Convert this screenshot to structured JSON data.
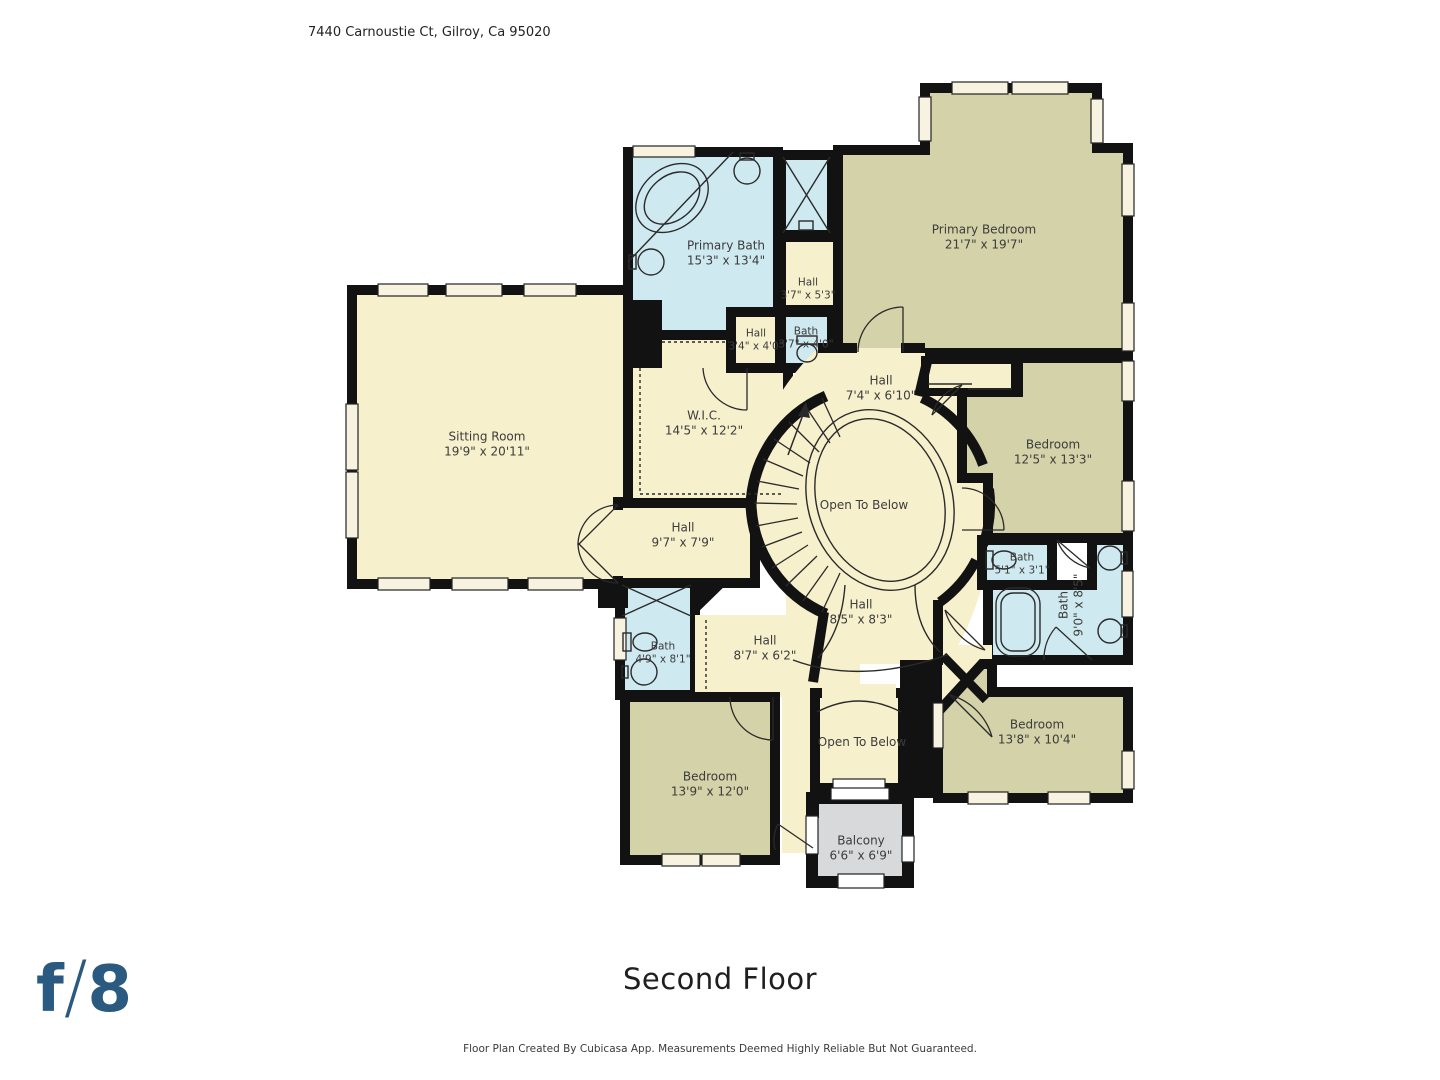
{
  "header": {
    "address": "7440 Carnoustie Ct, Gilroy, Ca 95020"
  },
  "rooms": {
    "sitting_room": {
      "name": "Sitting Room",
      "dims": "19'9\" x 20'11\""
    },
    "primary_bath": {
      "name": "Primary Bath",
      "dims": "15'3\" x 13'4\""
    },
    "hall_upper": {
      "name": "Hall",
      "dims": "3'7\" x 5'3\""
    },
    "hall_small": {
      "name": "Hall",
      "dims": "3'4\" x 4'0\""
    },
    "bath_small": {
      "name": "Bath",
      "dims": "3'7\" x 4'0\""
    },
    "primary_bedroom": {
      "name": "Primary Bedroom",
      "dims": "21'7\" x 19'7\""
    },
    "hall_top": {
      "name": "Hall",
      "dims": "7'4\" x 6'10\""
    },
    "wic": {
      "name": "W.I.C.",
      "dims": "14'5\" x 12'2\""
    },
    "bedroom_ne": {
      "name": "Bedroom",
      "dims": "12'5\" x 13'3\""
    },
    "open_below_center": {
      "name": "Open To Below"
    },
    "hall_west": {
      "name": "Hall",
      "dims": "9'7\" x 7'9\""
    },
    "bath_toilet": {
      "name": "Bath",
      "dims": "5'1\" x 3'1\""
    },
    "bath_east": {
      "name": "Bath",
      "dims": "9'0\" x 8'5\""
    },
    "hall_center": {
      "name": "Hall",
      "dims": "8'5\" x 8'3\""
    },
    "bath_west": {
      "name": "Bath",
      "dims": "4'9\" x 8'1\""
    },
    "hall_south": {
      "name": "Hall",
      "dims": "8'7\" x 6'2\""
    },
    "bedroom_sw": {
      "name": "Bedroom",
      "dims": "13'9\" x 12'0\""
    },
    "bedroom_se": {
      "name": "Bedroom",
      "dims": "13'8\" x 10'4\""
    },
    "open_below_south": {
      "name": "Open To Below"
    },
    "balcony": {
      "name": "Balcony",
      "dims": "6'6\" x 6'9\""
    }
  },
  "footer": {
    "floor_title": "Second Floor",
    "disclaimer": "Floor Plan Created By Cubicasa App. Measurements Deemed Highly Reliable But Not Guaranteed."
  },
  "logo": {
    "f": "f",
    "slash": "/",
    "eight": "8"
  },
  "colors": {
    "hall": "#f7f0cd",
    "bedroom": "#d4d2a8",
    "bath": "#cfe9f0",
    "balcony": "#d8d9db",
    "wall": "#121212",
    "logo_blue": "#2b5a80"
  }
}
